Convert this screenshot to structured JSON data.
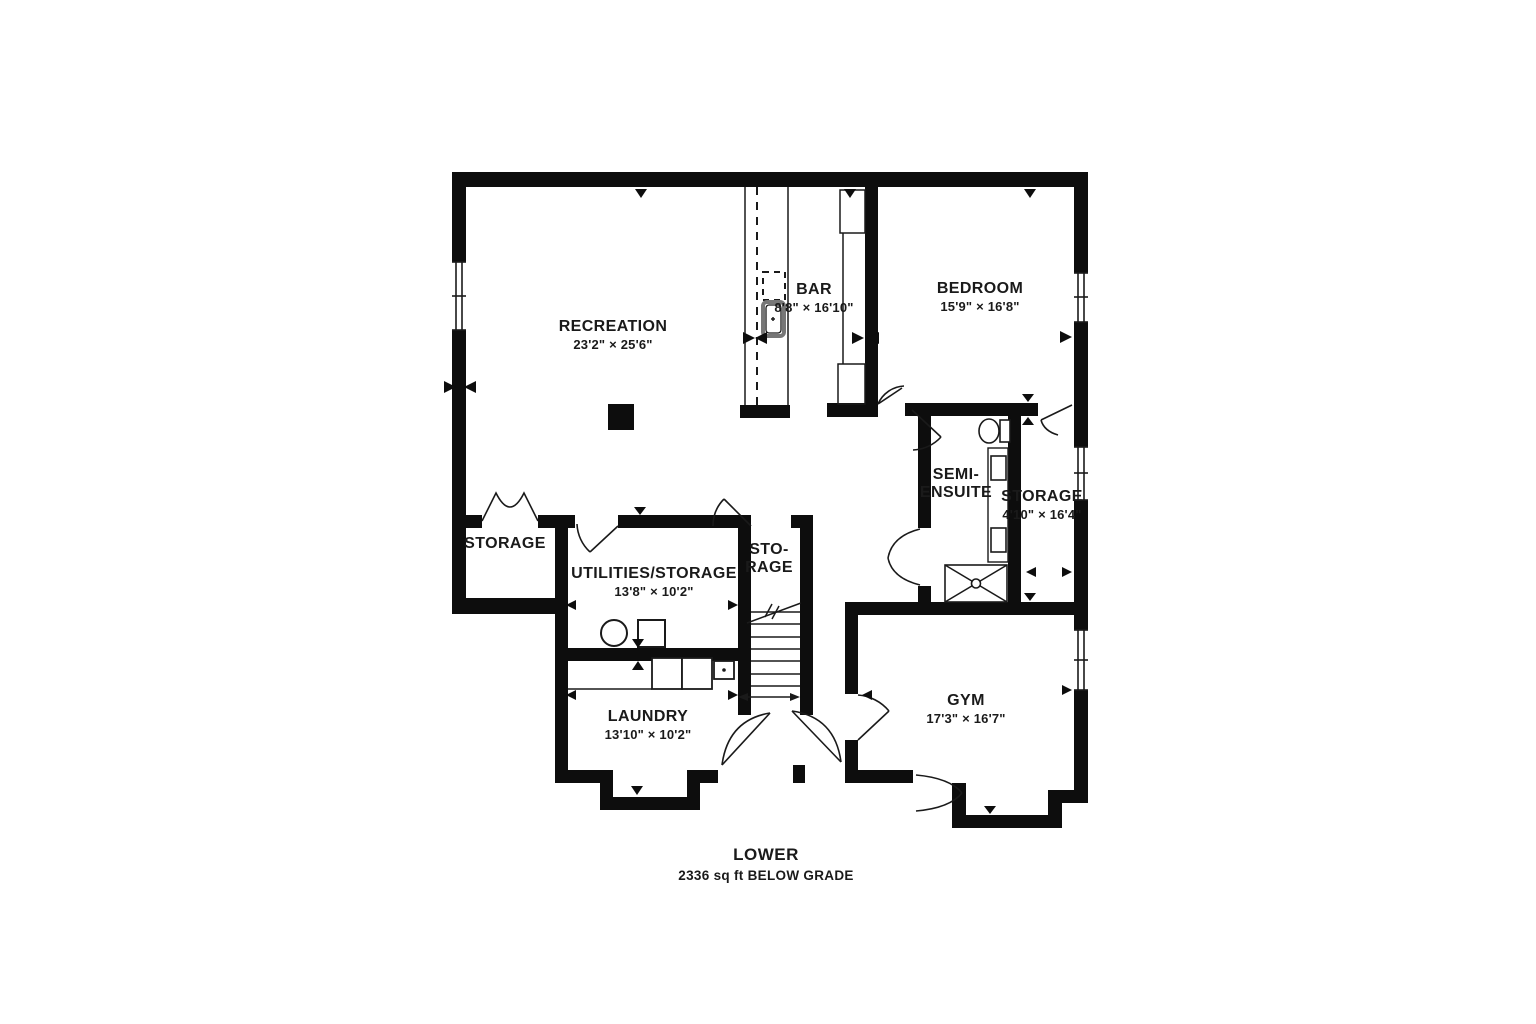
{
  "plan": {
    "title": "LOWER",
    "subtitle": "2336 sq ft BELOW GRADE"
  },
  "rooms": [
    {
      "name": "RECREATION",
      "dims": "23'2\" × 25'6\""
    },
    {
      "name": "BAR",
      "dims": "8'8\" × 16'10\""
    },
    {
      "name": "BEDROOM",
      "dims": "15'9\" × 16'8\""
    },
    {
      "name": "SEMI-\nENSUITE",
      "dims": ""
    },
    {
      "name": "STORAGE",
      "dims": "4'10\" × 16'4\""
    },
    {
      "name": "STORAGE",
      "dims": ""
    },
    {
      "name": "UTILITIES/STORAGE",
      "dims": "13'8\" × 10'2\""
    },
    {
      "name": "STO-\nRAGE",
      "dims": ""
    },
    {
      "name": "LAUNDRY",
      "dims": "13'10\" × 10'2\""
    },
    {
      "name": "GYM",
      "dims": "17'3\" × 16'7\""
    }
  ],
  "colors": {
    "wall": "#0d0d0d",
    "line": "#1a1a1a",
    "background": "#ffffff"
  }
}
